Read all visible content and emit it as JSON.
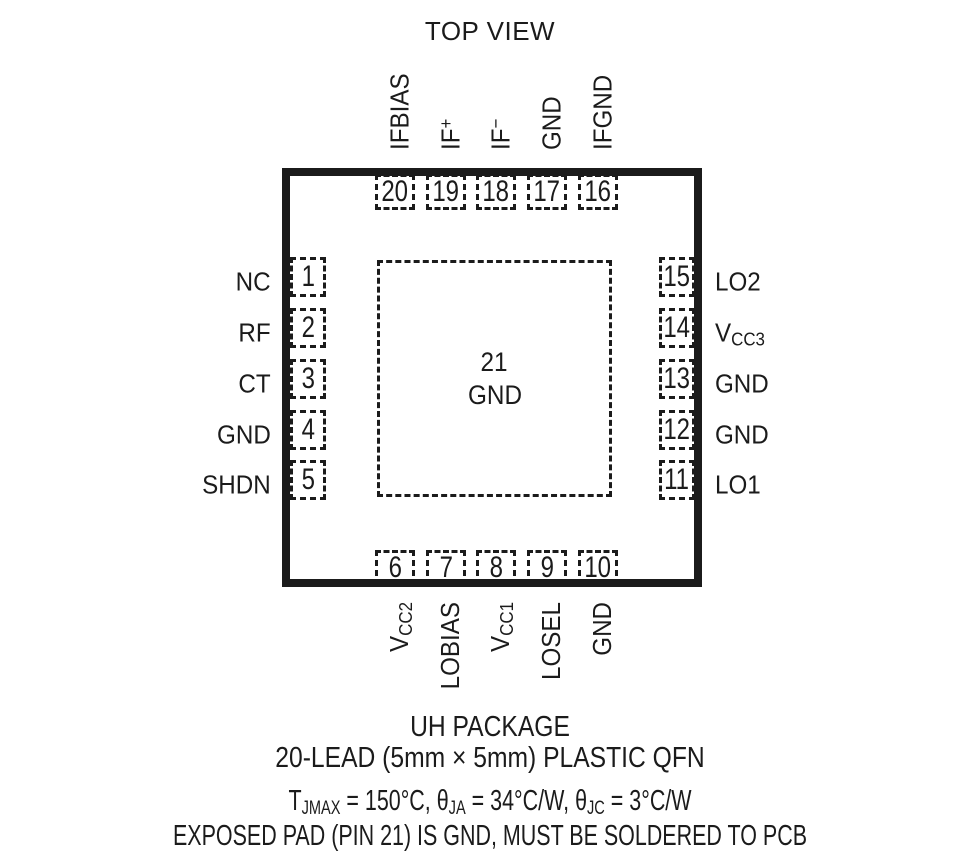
{
  "title": "TOP VIEW",
  "ink_color": "#1b1b1b",
  "package": {
    "center_pad": {
      "number": "21",
      "label": "GND"
    },
    "pins": {
      "top": [
        {
          "num": "20",
          "pre": "IFBIAS",
          "sup": "",
          "sub": ""
        },
        {
          "num": "19",
          "pre": "IF",
          "sup": "+",
          "sub": ""
        },
        {
          "num": "18",
          "pre": "IF",
          "sup": "−",
          "sub": ""
        },
        {
          "num": "17",
          "pre": "GND",
          "sup": "",
          "sub": ""
        },
        {
          "num": "16",
          "pre": "IFGND",
          "sup": "",
          "sub": ""
        }
      ],
      "left": [
        {
          "num": "1",
          "pre": "NC",
          "sup": "",
          "sub": ""
        },
        {
          "num": "2",
          "pre": "RF",
          "sup": "",
          "sub": ""
        },
        {
          "num": "3",
          "pre": "CT",
          "sup": "",
          "sub": ""
        },
        {
          "num": "4",
          "pre": "GND",
          "sup": "",
          "sub": ""
        },
        {
          "num": "5",
          "pre": "SHDN",
          "sup": "",
          "sub": ""
        }
      ],
      "right": [
        {
          "num": "15",
          "pre": "LO2",
          "sup": "",
          "sub": ""
        },
        {
          "num": "14",
          "pre": "V",
          "sup": "",
          "sub": "CC3"
        },
        {
          "num": "13",
          "pre": "GND",
          "sup": "",
          "sub": ""
        },
        {
          "num": "12",
          "pre": "GND",
          "sup": "",
          "sub": ""
        },
        {
          "num": "11",
          "pre": "LO1",
          "sup": "",
          "sub": ""
        }
      ],
      "bottom": [
        {
          "num": "6",
          "pre": "V",
          "sup": "",
          "sub": "CC2"
        },
        {
          "num": "7",
          "pre": "LOBIAS",
          "sup": "",
          "sub": ""
        },
        {
          "num": "8",
          "pre": "V",
          "sup": "",
          "sub": "CC1"
        },
        {
          "num": "9",
          "pre": "LOSEL",
          "sup": "",
          "sub": ""
        },
        {
          "num": "10",
          "pre": "GND",
          "sup": "",
          "sub": ""
        }
      ]
    }
  },
  "footer": {
    "line1": "UH PACKAGE",
    "line2": "20-LEAD (5mm × 5mm) PLASTIC QFN",
    "thermal": {
      "t_pre": "T",
      "t_sub": "JMAX",
      "t_val": " = 150°C, ",
      "th1_pre": "θ",
      "th1_sub": "JA",
      "th1_val": " = 34°C/W, ",
      "th2_pre": "θ",
      "th2_sub": "JC",
      "th2_val": " = 3°C/W"
    },
    "line4": "EXPOSED PAD (PIN 21) IS GND, MUST BE SOLDERED TO PCB"
  }
}
